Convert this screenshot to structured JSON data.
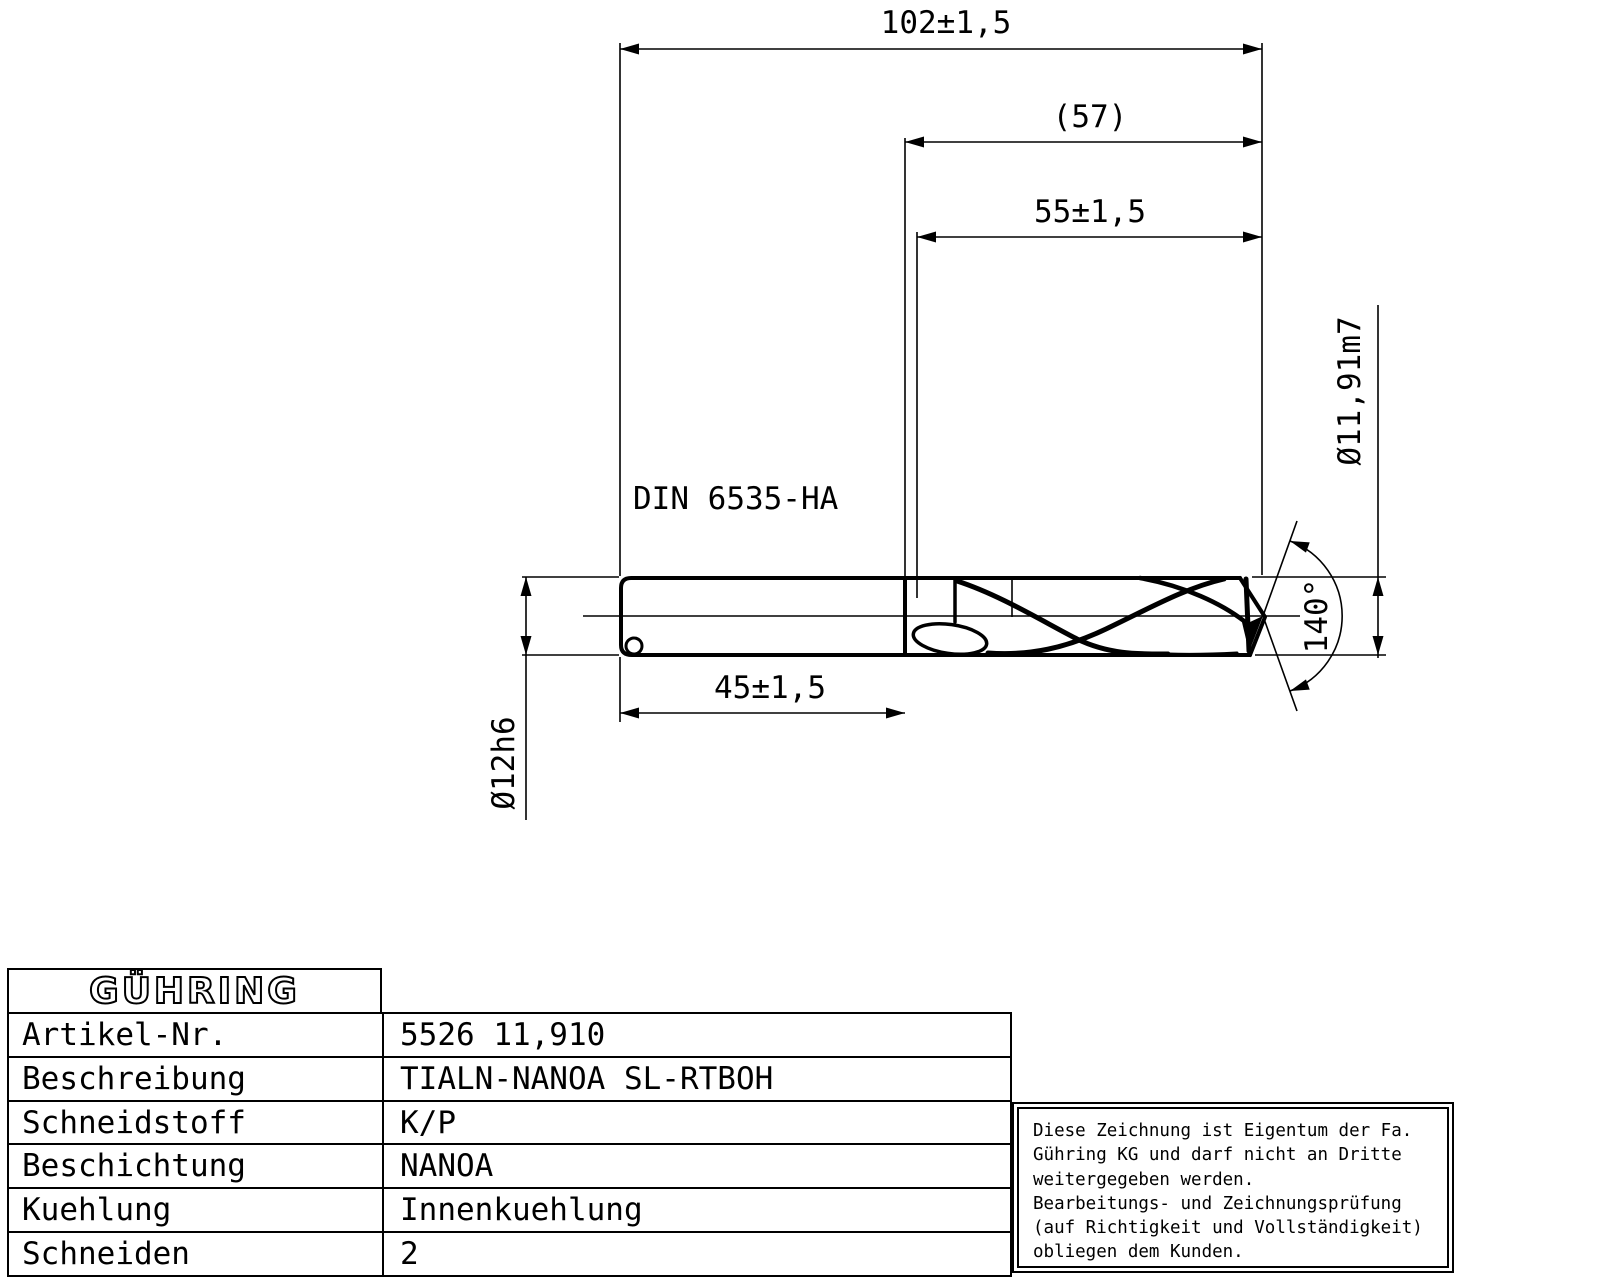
{
  "drawing": {
    "labels": {
      "din_standard": "DIN 6535-HA",
      "dim_overall_length": "102±1,5",
      "dim_ref_length": "(57)",
      "dim_flute_length": "55±1,5",
      "dim_shank_length": "45±1,5",
      "dia_shank": "Ø12h6",
      "dia_cutting": "Ø11,91m7",
      "point_angle": "140°"
    }
  },
  "title_block": {
    "logo": "GÜHRING",
    "rows": [
      {
        "label": "Artikel-Nr.",
        "value": "5526 11,910"
      },
      {
        "label": "Beschreibung",
        "value": "TIALN-NANOA SL-RTBOH"
      },
      {
        "label": "Schneidstoff",
        "value": "K/P"
      },
      {
        "label": "Beschichtung",
        "value": "NANOA"
      },
      {
        "label": "Kuehlung",
        "value": "Innenkuehlung"
      },
      {
        "label": "Schneiden",
        "value": "2"
      }
    ]
  },
  "notice": {
    "lines": [
      "Diese Zeichnung ist Eigentum der Fa.",
      "Gühring KG und darf nicht an Dritte",
      "weitergegeben werden.",
      "Bearbeitungs- und Zeichnungsprüfung",
      "(auf Richtigkeit und Vollständigkeit)",
      "obliegen dem Kunden."
    ]
  },
  "colors": {
    "line": "#000000",
    "background": "#ffffff"
  }
}
